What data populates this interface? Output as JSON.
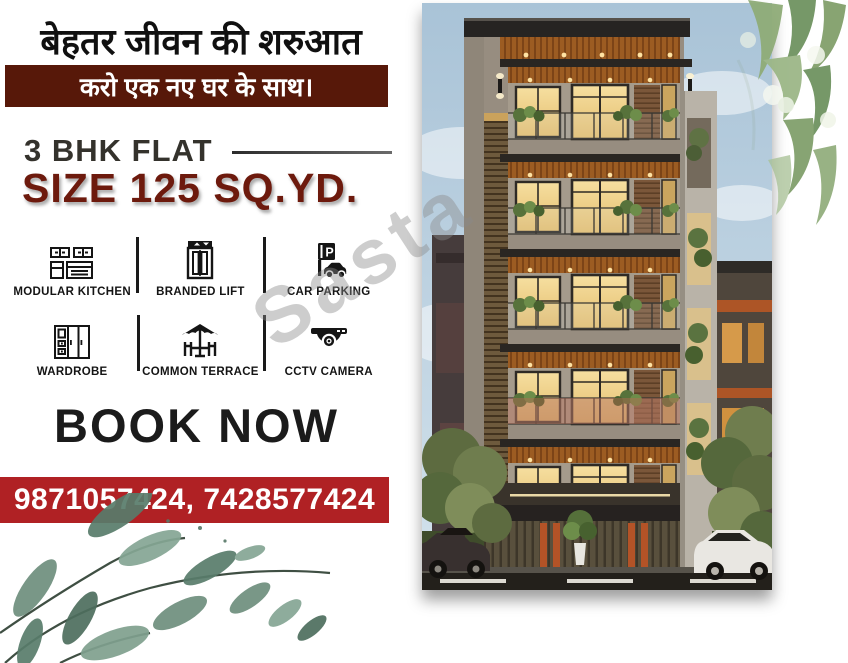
{
  "poster": {
    "headline_hi": "बेहतर जीवन की शरुआत",
    "subheadline_hi": "करो एक नए घर के साथ।",
    "flat_type": "3 BHK FLAT",
    "size_line": "SIZE 125 SQ.YD.",
    "book_now": "BOOK NOW",
    "phone_numbers": "9871057424, 7428577424",
    "watermark": "Sasta",
    "features": [
      {
        "label": "MODULAR KITCHEN",
        "icon": "kitchen-icon"
      },
      {
        "label": "BRANDED LIFT",
        "icon": "lift-icon"
      },
      {
        "label": "CAR PARKING",
        "icon": "parking-icon"
      },
      {
        "label": "WARDROBE",
        "icon": "wardrobe-icon"
      },
      {
        "label": "COMMON TERRACE",
        "icon": "terrace-icon"
      },
      {
        "label": "CCTV CAMERA",
        "icon": "cctv-icon"
      }
    ],
    "colors": {
      "sub_banner_bg": "#571809",
      "size_text": "#6d1a0d",
      "phone_banner_bg": "#b02124",
      "headline_text": "#101010",
      "sky": "#b4cadc",
      "window_glow": "#f0d189",
      "wood_accent": "#9c5c22",
      "leaf_green": "#6f9381"
    }
  }
}
